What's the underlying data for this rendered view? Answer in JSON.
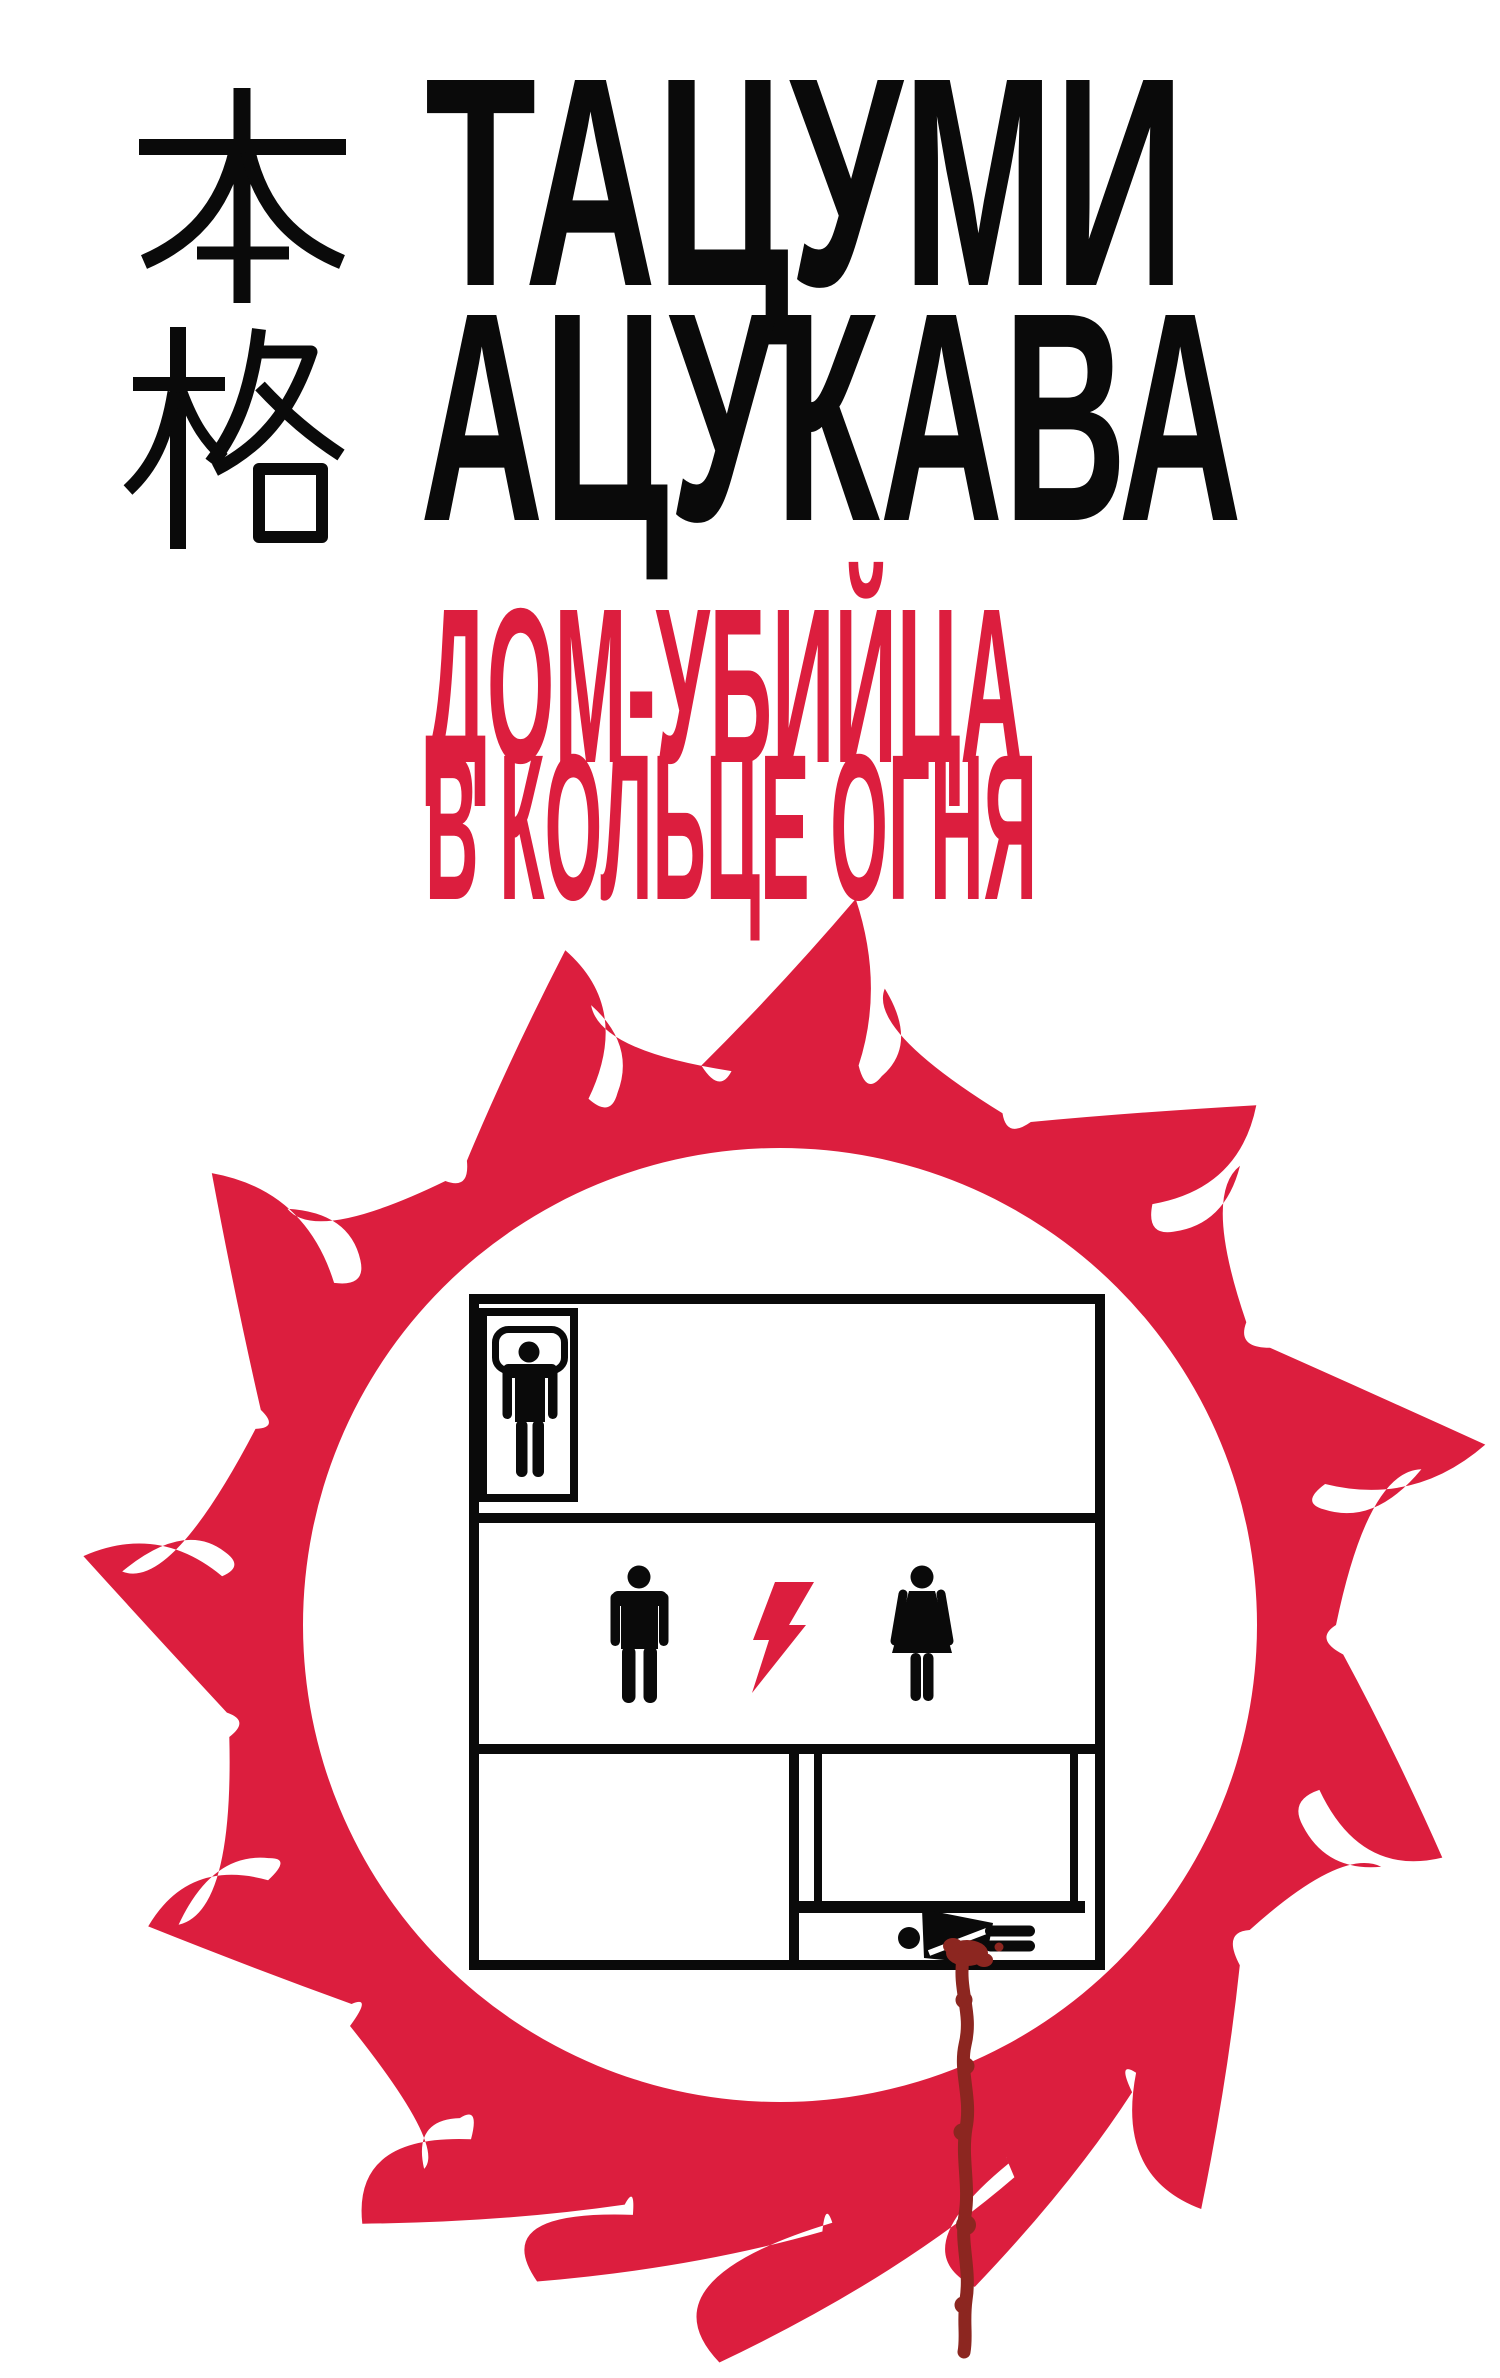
{
  "cover": {
    "genre_mark": {
      "kanji_top": "本",
      "kanji_bottom": "格"
    },
    "author": {
      "line1": "ТАЦУМИ",
      "line2": "АЦУКАВА"
    },
    "title": {
      "line1": "ДОМ-УБИЙЦА",
      "line2": "В КОЛЬЦЕ ОГНЯ"
    },
    "colors": {
      "accent_red": "#DC1E3E",
      "blood_red": "#8C2620",
      "ink_black": "#0A0A0A",
      "background": "#FFFFFF"
    },
    "emblem": {
      "icons": [
        "ring-of-fire-icon",
        "floor-plan-icon",
        "sleeping-person-icon",
        "man-icon",
        "lightning-bolt-icon",
        "woman-icon",
        "dead-body-icon",
        "blood-drip-icon"
      ]
    }
  }
}
